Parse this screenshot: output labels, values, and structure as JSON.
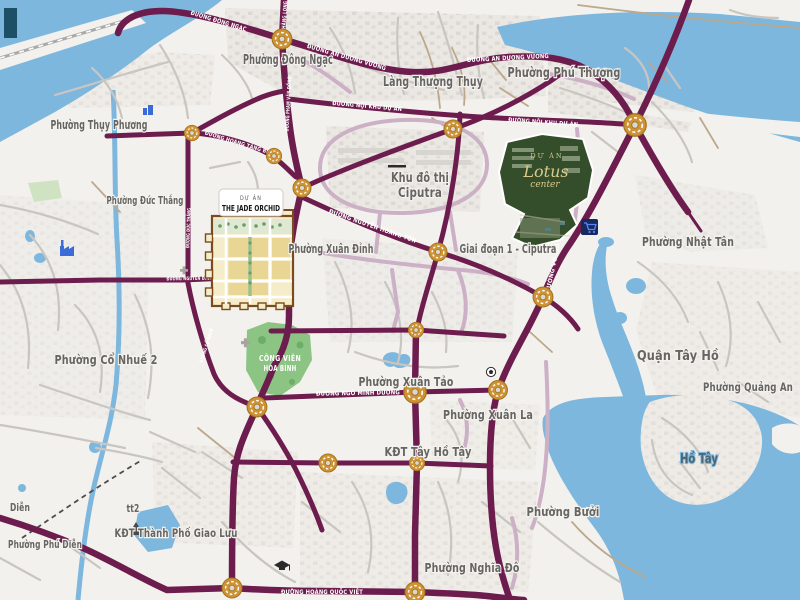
{
  "map": {
    "kind": "real-estate project location map (northwest Hanoi)",
    "areas": {
      "thuy_phuong": "Phường Thụy Phương",
      "dong_ngac": "Phường Đông Ngạc",
      "lang_thuong_thuy": "Làng Thượng Thụy",
      "phu_thuong": "Phường Phú Thượng",
      "duc_thang": "Phường Đức Thắng",
      "xuan_dinh": "Phường Xuân Đỉnh",
      "khu_do_thi_l1": "Khu đô thị",
      "khu_do_thi_l2": "Ciputra",
      "giai_doan_1": "Giai đoạn 1 - Ciputra",
      "nhat_tan": "Phường Nhật Tân",
      "quan_tay_ho": "Quận Tây Hồ",
      "quang_an": "Phường Quảng An",
      "co_nhue_2": "Phường Cổ Nhuế 2",
      "xuan_tao": "Phường Xuân Tảo",
      "xuan_la": "Phường Xuân La",
      "kdt_tay_ho_tay": "KĐT Tây Hồ Tây",
      "buoi": "Phường Bưởi",
      "ho_tay": "Hồ Tây",
      "nghia_do": "Phường Nghĩa Đô",
      "phu_dien": "Phường Phú Diễn",
      "dien": "Diễn",
      "tt2": "tt2",
      "giao_luu": "KĐT Thành Phố Giao Lưu",
      "park_l1": "CÔNG VIÊN",
      "park_l2": "HÒA BÌNH"
    },
    "roads": {
      "dong_ngac": "ĐƯỜNG ĐÔNG NGẠC",
      "cau_thang_long": "CẦU THĂNG LONG",
      "an_duong_vuong": "ĐƯỜNG AN DƯƠNG VƯƠNG",
      "noi_khu_du_an": "ĐƯỜNG NỘI KHU DỰ ÁN",
      "hoang_tang_bi": "ĐƯỜNG HOÀNG TĂNG BÍ",
      "pham_van_dong": "ĐƯỜNG PHẠM VĂN ĐỒNG",
      "nguyen_hoang_ton": "ĐƯỜNG NGUYỄN HOÀNG TÔN",
      "vo_chi_cong": "ĐƯỜNG VÕ CHÍ CÔNG",
      "ngo_minh_duong": "ĐƯỜNG NGÔ MINH DƯƠNG",
      "hoang_quoc_viet": "ĐƯỜNG HOÀNG QUỐC VIỆT",
      "nguyen_dinh_tu": "ĐƯỜNG NGUYỄN ĐÌNH TỨ",
      "duc_thang": "ĐƯỜNG ĐỨC THẮNG",
      "co_nhue": "ĐƯỜNG CỔ NHUẾ"
    },
    "projects": {
      "jade": {
        "tag": "DỰ ÁN",
        "name": "THE JADE ORCHID"
      },
      "lotus": {
        "tag": "DỰ ÁN",
        "name": "Lotus",
        "sub": "center"
      }
    },
    "colors": {
      "road_primary": "#6d1c4e",
      "road_secondary": "#ccb0c6",
      "water": "#7db7de",
      "land": "#f3f1ed",
      "park_green": "#8cc484",
      "roundabout_gold": "#cd9336",
      "project_green": "#344d2a",
      "project_gold": "#dcc98b",
      "label_gray": "#666562"
    }
  }
}
